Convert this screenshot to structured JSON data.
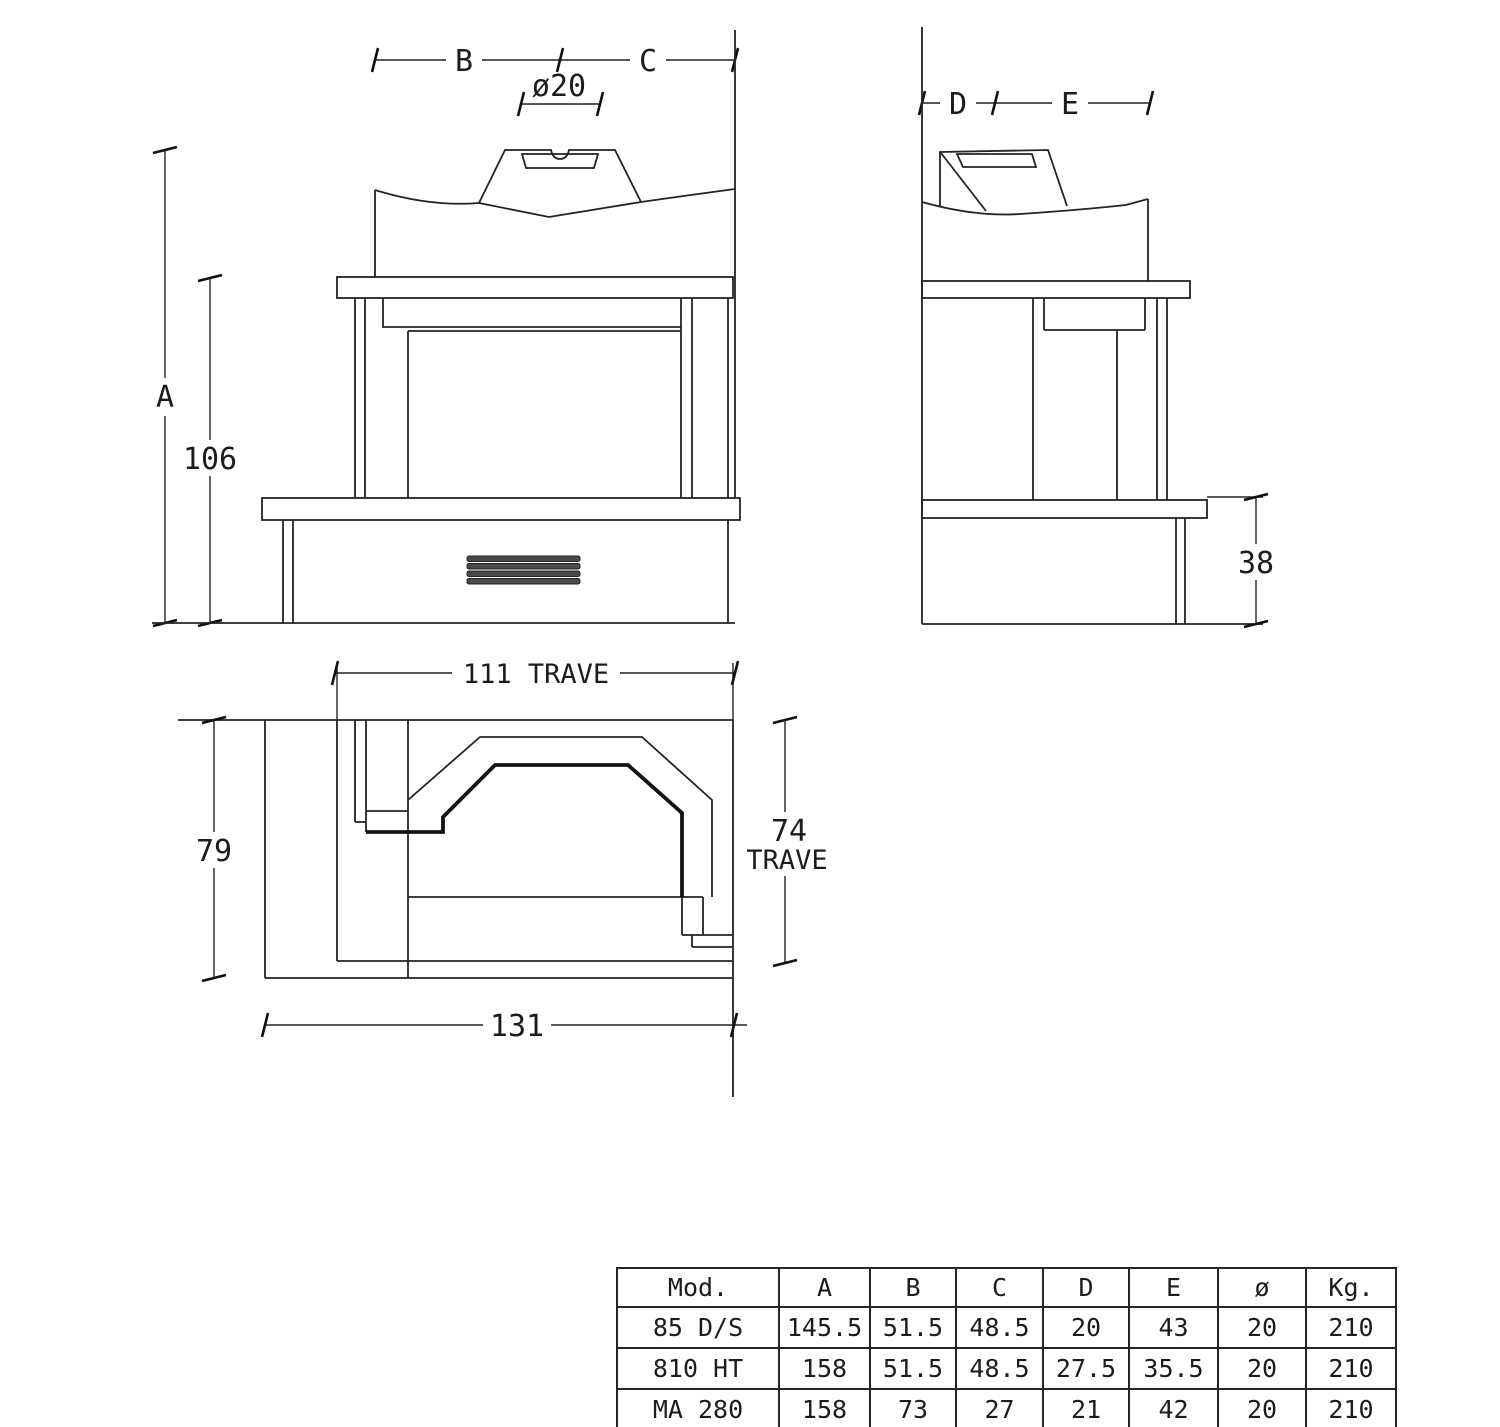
{
  "colors": {
    "background": "#ffffff",
    "line": "#232323",
    "text": "#1c1c1c"
  },
  "front_view": {
    "label_b": "B",
    "label_c": "C",
    "label_flue_diameter": "ø20",
    "label_a": "A",
    "label_mantel_height": "106"
  },
  "side_view": {
    "label_d": "D",
    "label_e": "E",
    "label_hearth_height": "38"
  },
  "plan_view": {
    "label_beam_length": "111  TRAVE",
    "label_depth": "79",
    "label_beam_depth_num": "74",
    "label_beam_depth_word": "TRAVE",
    "label_overall_width": "131"
  },
  "table": {
    "headers": [
      "Mod.",
      "A",
      "B",
      "C",
      "D",
      "E",
      "ø",
      "Kg."
    ],
    "rows": [
      [
        "85 D/S",
        "145.5",
        "51.5",
        "48.5",
        "20",
        "43",
        "20",
        "210"
      ],
      [
        "810 HT",
        "158",
        "51.5",
        "48.5",
        "27.5",
        "35.5",
        "20",
        "210"
      ],
      [
        "MA 280",
        "158",
        "73",
        "27",
        "21",
        "42",
        "20",
        "210"
      ]
    ]
  }
}
